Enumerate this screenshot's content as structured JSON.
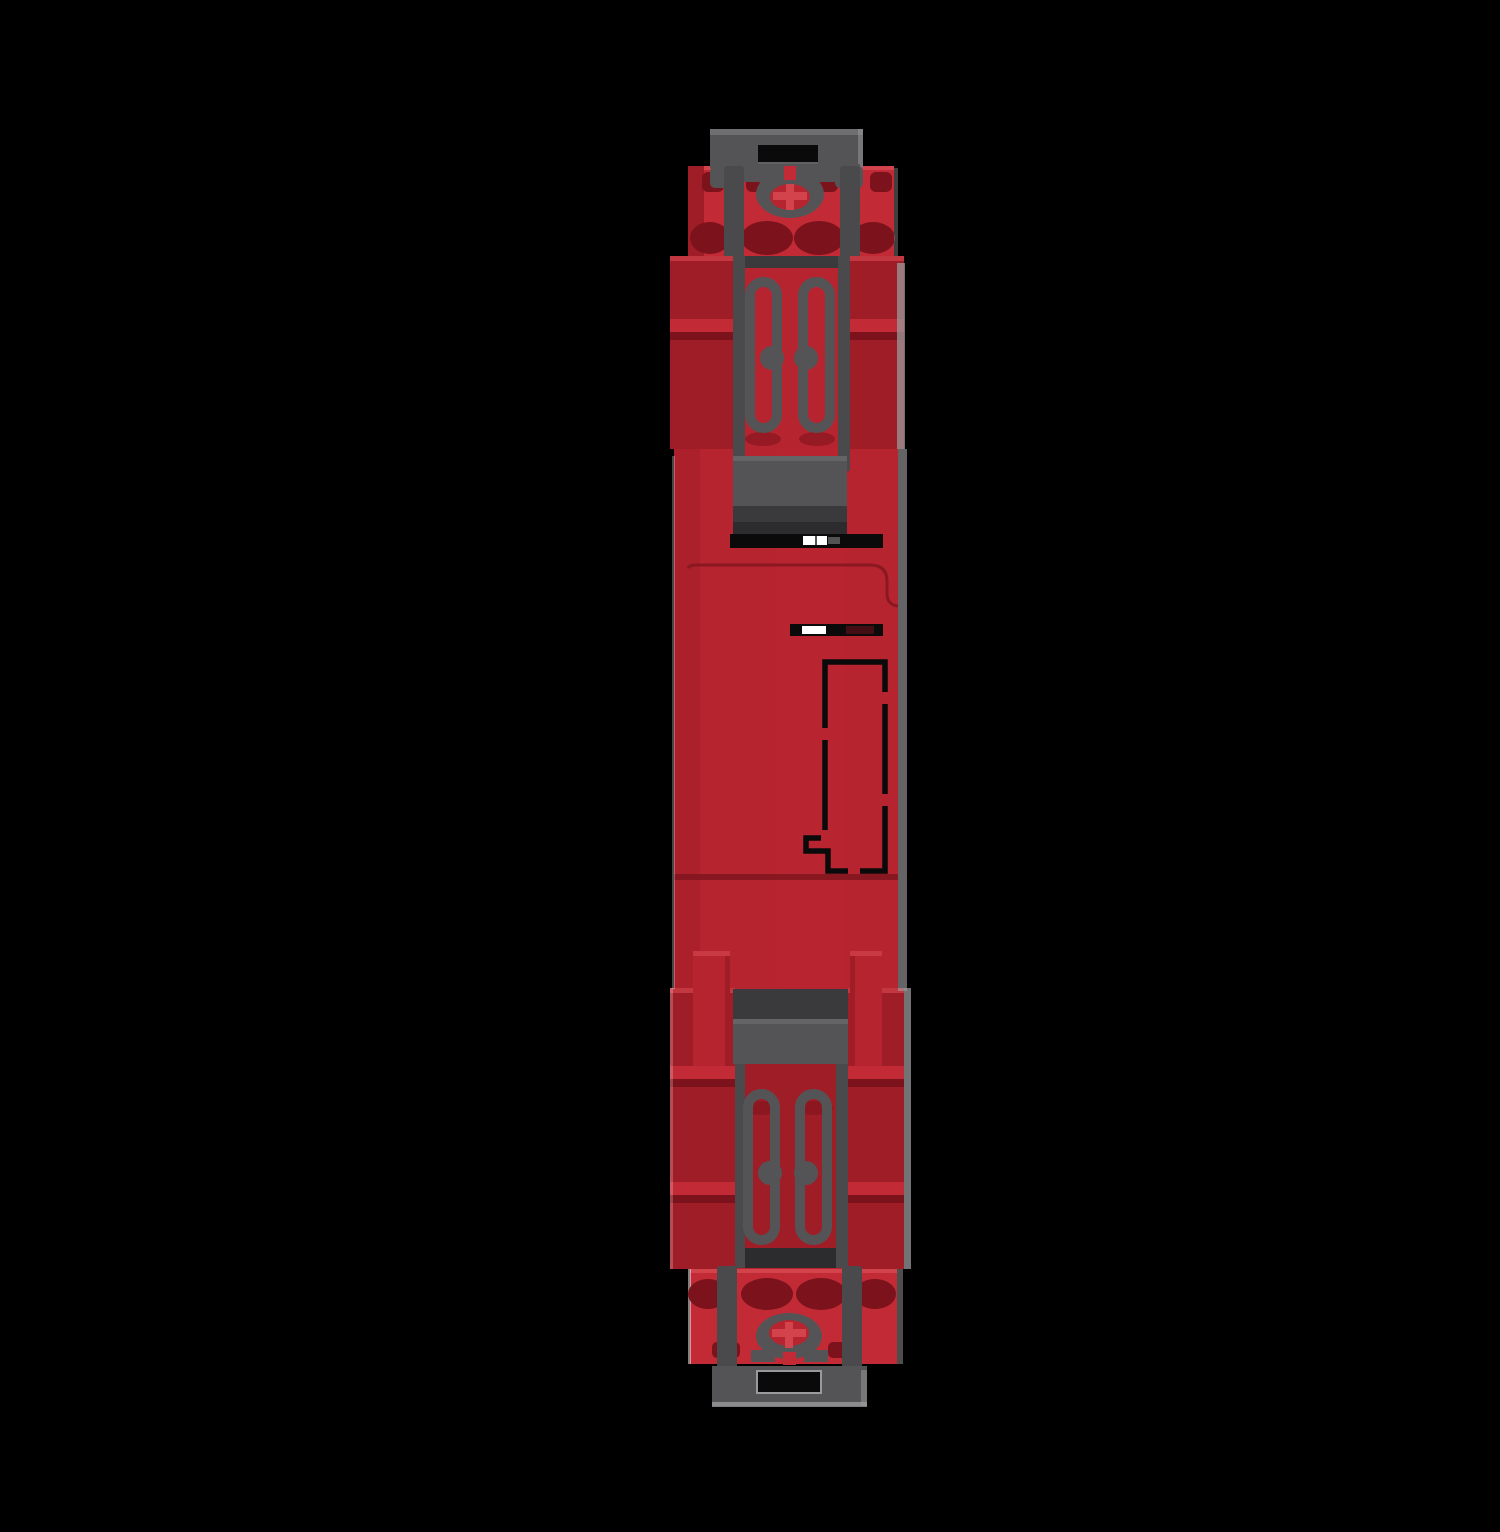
{
  "scene": {
    "title": "Red modular DIN-rail device with grey mounting clips, vertical edge profile on black background",
    "description": "3D product render, edge-on profile view of a slim red electrical module. A dark grey DIN-rail clip with a rectangular slot and an elliptical screw ring sits at top and bottom. Red terminal blocks with dark wire ports sit behind each clip. Two grey spring-contact loops with round bosses show in the upper housing window and in the lower grey carriage window. The red mid-section carries two black slots with small white markers, a black dashed cut-out outline with a keyed notch, ribbed side flanges, and a light grey highlight along the right edge.",
    "background": "#000000",
    "colors": {
      "background": "#000000",
      "red_bright": "#c22b36",
      "red_face": "#b6242f",
      "red_dark": "#9e1d27",
      "red_deep": "#7c121b",
      "red_edge": "#d2434c",
      "red_shadow": "#7f151d",
      "gray_top": "#6f6f71",
      "gray_mid": "#545457",
      "gray_arm": "#4a4a4d",
      "gray_dark": "#3a3a3d",
      "gray_darker": "#2c2c2e",
      "gray_highlight": "#9a9a9c",
      "black_detail": "#0a0a0a",
      "white_detail": "#ffffff"
    },
    "parts": [
      {
        "id": "top-terminal-block",
        "label": "Red terminal block with dark wire ports (top)"
      },
      {
        "id": "top-din-clip",
        "label": "Grey DIN-rail clip with rectangular slot and screw ring (top)"
      },
      {
        "id": "upper-housing",
        "label": "Upper red housing with ribbed side flanges"
      },
      {
        "id": "upper-contact-window",
        "label": "Two grey spring-contact loops with round bosses"
      },
      {
        "id": "upper-latch",
        "label": "Grey latch plate with black slot and white marker"
      },
      {
        "id": "center-housing",
        "label": "Red mid-section housing"
      },
      {
        "id": "marking-slot",
        "label": "Black slot with white marker"
      },
      {
        "id": "dashed-cutout-outline",
        "label": "Black dashed cut-out outline with keyed notch"
      },
      {
        "id": "lower-housing",
        "label": "Lower red housing with double-ribbed side flanges and posts"
      },
      {
        "id": "lower-clip-carriage",
        "label": "Grey clip carriage window with two spring-contact loops"
      },
      {
        "id": "bottom-terminal-block",
        "label": "Red terminal block with dark wire ports (bottom)"
      },
      {
        "id": "bottom-din-clip",
        "label": "Grey DIN-rail clip with rectangular slot and screw ring (bottom)"
      }
    ]
  }
}
